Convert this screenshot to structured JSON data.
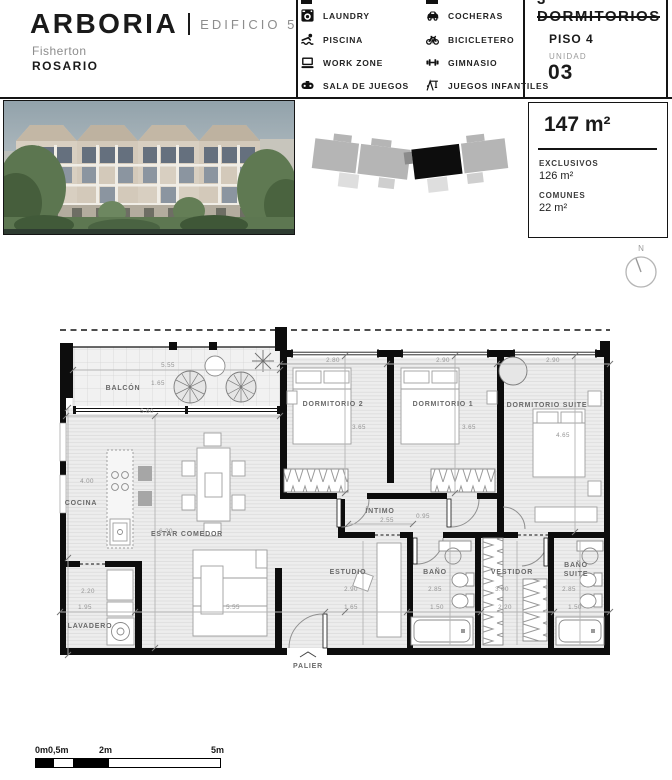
{
  "header": {
    "brand": "ARBORIA",
    "building": "EDIFICIO 5",
    "location1": "Fisherton",
    "location2": "ROSARIO",
    "amenities": [
      {
        "icon": "laundry-icon",
        "label": "LAUNDRY"
      },
      {
        "icon": "pool-icon",
        "label": "PISCINA"
      },
      {
        "icon": "workzone-icon",
        "label": "WORK ZONE"
      },
      {
        "icon": "gameroom-icon",
        "label": "SALA DE JUEGOS"
      },
      {
        "icon": "car-icon",
        "label": "COCHERAS"
      },
      {
        "icon": "bike-icon",
        "label": "BICICLETERO"
      },
      {
        "icon": "gym-icon",
        "label": "GIMNASIO"
      },
      {
        "icon": "playground-icon",
        "label": "JUEGOS INFANTILES"
      }
    ],
    "unit": {
      "title": "3 DORMITORIOS",
      "floor": "PISO 4",
      "unit_label": "UNIDAD",
      "unit_number": "03"
    }
  },
  "areas": {
    "total": "147 m²",
    "exclusive_label": "EXCLUSIVOS",
    "exclusive": "126 m²",
    "common_label": "COMUNES",
    "common": "22 m²"
  },
  "plan": {
    "north": "N",
    "rooms": {
      "balcon": "BALCÓN",
      "cocina": "COCINA",
      "estar": "ESTAR COMEDOR",
      "lavadero": "LAVADERO",
      "dorm2": "DORMITORIO 2",
      "dorm1": "DORMITORIO 1",
      "suite": "DORMITORIO SUITE",
      "intimo": "ÍNTIMO",
      "estudio": "ESTUDIO",
      "bano": "BAÑO",
      "vestidor": "VESTIDOR",
      "bano_s1": "BAÑO",
      "bano_s2": "SUITE",
      "palier": "PALIER"
    },
    "dims": {
      "balcon_w": "5.55",
      "balcon_d": "1.65",
      "estar_w": "5.80",
      "cocina_h": "4.00",
      "estar_h": "6.20",
      "sofa_w": "5.55",
      "lav_h": "2.20",
      "lav_w": "1.95",
      "d2_w": "2.80",
      "d2_h": "3.65",
      "d1_w": "2.90",
      "d1_h": "3.65",
      "suite_w": "2.90",
      "suite_h": "4.65",
      "intimo_w": "2.55",
      "intimo_h": "0.95",
      "estudio_h": "2.90",
      "estudio_w": "1.65",
      "bano_h": "2.85",
      "bano_w": "1.50",
      "vest_h": "3.00",
      "vest_w": "2.20",
      "bsuite_h": "2.85",
      "bsuite_w": "1.50"
    }
  },
  "scalebar": {
    "labels": [
      "0m",
      "0,5m",
      "2m",
      "5m"
    ]
  }
}
